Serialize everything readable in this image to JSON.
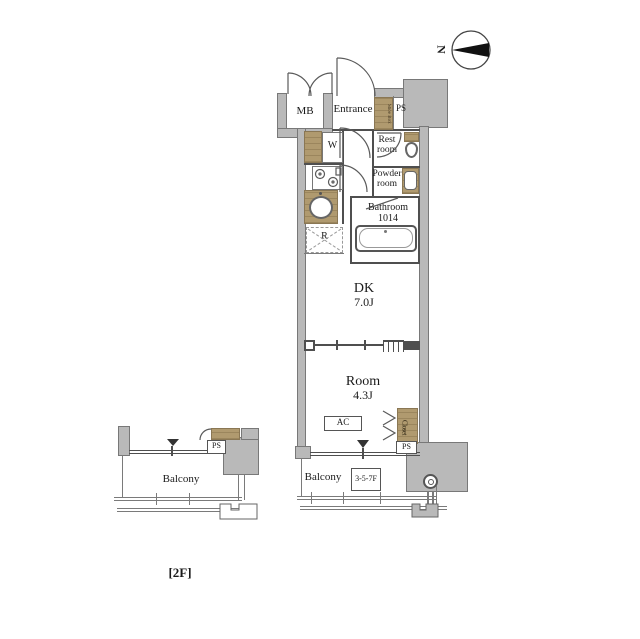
{
  "colors": {
    "wall_fill": "#b9b9b9",
    "wall_edge": "#787878",
    "partition_line": "#4f4f4f",
    "wood_fixture": "#b09a6f",
    "text": "#1a1a1a"
  },
  "compass": {
    "letter": "N"
  },
  "floor_tag": "[2F]",
  "main_unit": {
    "mb": "MB",
    "entrance": "Entrance",
    "shoe_box": "Shoe Box",
    "ps_top": "PS",
    "washer": "W",
    "rest_room": [
      "Rest",
      "room"
    ],
    "powder_room": [
      "Powder",
      "room"
    ],
    "bathroom": [
      "Bathroom",
      "1014"
    ],
    "fridge": "R",
    "dk": [
      "DK",
      "7.0J"
    ],
    "room": [
      "Room",
      "4.3J"
    ],
    "ac": "AC",
    "closet": "Closet",
    "ps_bottom": "PS",
    "balcony": "Balcony",
    "floors_box": "3-5-7F"
  },
  "left_unit": {
    "balcony": "Balcony",
    "ps": "PS"
  }
}
